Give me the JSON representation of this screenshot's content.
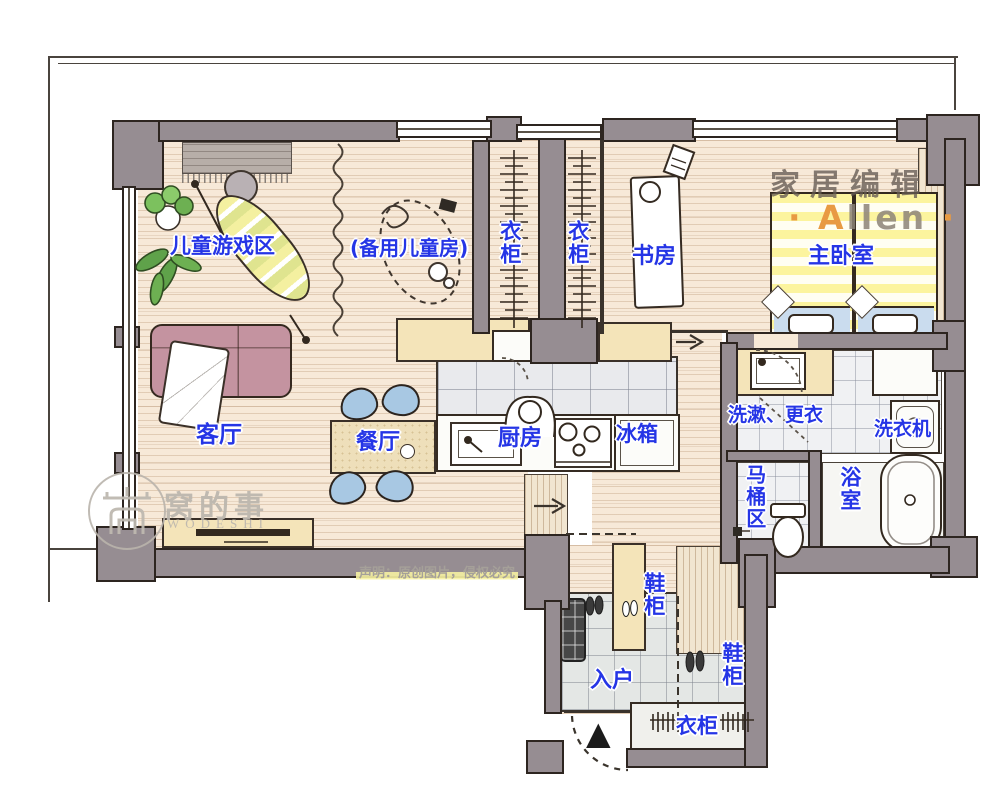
{
  "labels": {
    "play_area": "儿童游戏区",
    "spare_room": "(备用儿童房)",
    "closet_a": "衣柜",
    "closet_b": "衣柜",
    "study": "书房",
    "master_bedroom": "主卧室",
    "living_room": "客厅",
    "dining_room": "餐厅",
    "kitchen": "厨房",
    "fridge": "冰箱",
    "washroom": "洗漱、更衣",
    "washing_machine": "洗衣机",
    "toilet_area": "马桶区",
    "bathroom": "浴室",
    "shoe_cabinet_a": "鞋柜",
    "shoe_cabinet_b": "鞋柜",
    "entry": "入户",
    "entry_closet": "衣柜"
  },
  "watermarks": {
    "brand_cn": "家居编辑",
    "brand_dot_left": "·",
    "brand_name_initial": "A",
    "brand_name_rest": "llen",
    "brand_dot_right": "·",
    "site_cn": "窝的事",
    "site_en": "WODESHI",
    "disclaimer": "声明：原创图片，侵权必究"
  },
  "icons": {
    "entry_arrow": "▲"
  },
  "colors": {
    "label_blue": "#2535e6",
    "wall_gray": "#968d92",
    "wood_floor": "#f7e9d8",
    "cabinet_cream": "#f4e4b9",
    "bed_yellow": "#fbf39c",
    "bedding_blue": "#cadcee",
    "chair_blue": "#a8c8e3",
    "sofa_pink": "#c493a0",
    "plant_green": "#5fa24a",
    "watermark_orange": "#e89a43",
    "highlight_yellow": "#f6f1a2"
  }
}
